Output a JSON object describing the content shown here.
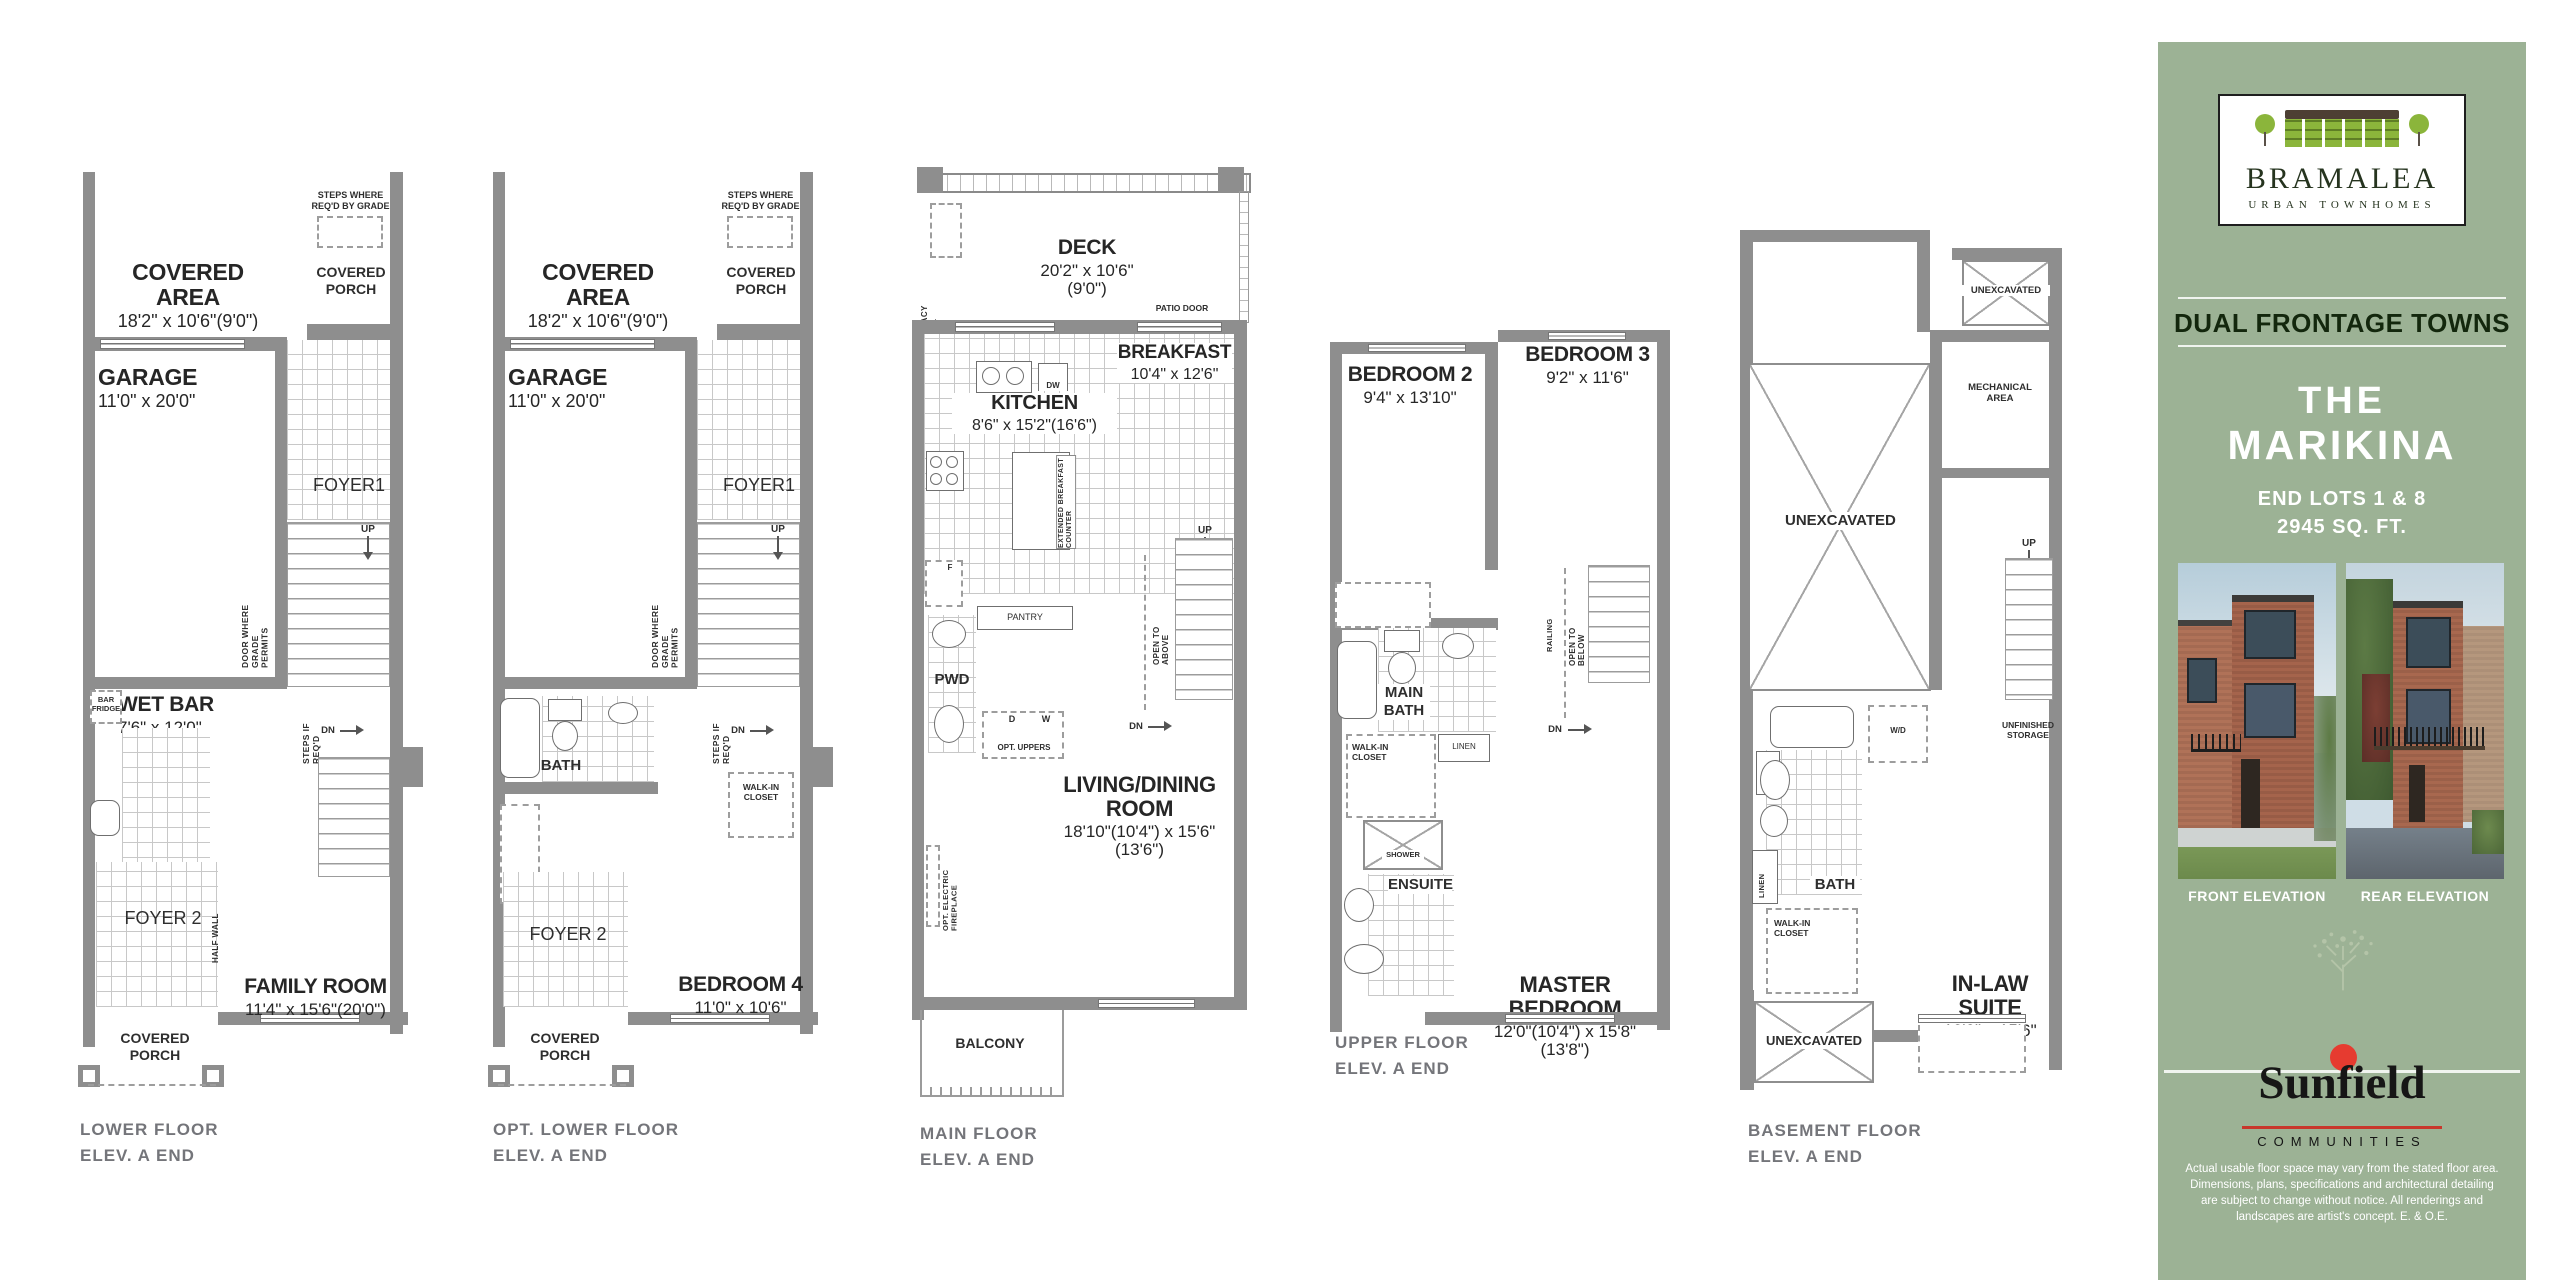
{
  "colors": {
    "panelGreen": "#9cb295",
    "wallGray": "#8e8e8e",
    "logoGreen": "#8bb53b",
    "roofBrown": "#4d3f33",
    "sunRed": "#e63b30"
  },
  "captions": {
    "lower": "LOWER FLOOR\nELEV. A END",
    "optLower": "OPT. LOWER FLOOR\nELEV. A END",
    "main": "MAIN FLOOR\nELEV. A END",
    "upper": "UPPER FLOOR\nELEV. A END",
    "basement": "BASEMENT FLOOR\nELEV. A END"
  },
  "lower": {
    "coveredArea": "COVERED AREA",
    "coveredAreaDims": "18'2\" x 10'6\"(9'0\")",
    "stepsGrade": "STEPS WHERE\nREQ'D BY GRADE",
    "coveredPorch": "COVERED\nPORCH",
    "garage": "GARAGE",
    "garageDims": "11'0\" x 20'0\"",
    "foyer1": "FOYER1",
    "up": "UP",
    "doorGrade": "DOOR WHERE\nGRADE PERMITS",
    "wetBar": "WET BAR",
    "wetBarDims": "7'6\" x 12'0\"",
    "barFridge": "BAR\nFRIDGE",
    "stepsReq": "STEPS IF REQ'D",
    "dn": "DN",
    "foyer2": "FOYER 2",
    "halfWall": "HALF WALL",
    "familyRoom": "FAMILY ROOM",
    "familyRoomDims": "11'4\" x 15'6\"(20'0\")",
    "porchBottom": "COVERED\nPORCH"
  },
  "optLower": {
    "coveredArea": "COVERED AREA",
    "coveredAreaDims": "18'2\" x 10'6\"(9'0\")",
    "stepsGrade": "STEPS WHERE\nREQ'D BY GRADE",
    "coveredPorch": "COVERED\nPORCH",
    "garage": "GARAGE",
    "garageDims": "11'0\" x 20'0\"",
    "foyer1": "FOYER1",
    "up": "UP",
    "doorGrade": "DOOR WHERE\nGRADE PERMITS",
    "bath": "BATH",
    "walkIn": "WALK-IN\nCLOSET",
    "stepsReq": "STEPS IF REQ'D",
    "dn": "DN",
    "foyer2": "FOYER 2",
    "bedroom4": "BEDROOM 4",
    "bedroom4Dims": "11'0\" x 10'6\"",
    "porchBottom": "COVERED\nPORCH"
  },
  "main": {
    "deck": "DECK",
    "deckDims": "20'2\" x 10'6\"(9'0\")",
    "privacyWall": "PRIVACY WALL",
    "patioDoor": "PATIO DOOR",
    "breakfast": "BREAKFAST",
    "breakfastDims": "10'4\" x 12'6\"",
    "kitchen": "KITCHEN",
    "kitchenDims": "8'6\" x 15'2\"(16'6\")",
    "dw": "DW",
    "extCounter": "EXTENDED BREAKFAST COUNTER",
    "fridge": "F",
    "pantry": "PANTRY",
    "pwd": "PWD",
    "d": "D",
    "w": "W",
    "optUppers": "OPT. UPPERS",
    "up": "UP",
    "openAbove": "OPEN TO ABOVE",
    "dn": "DN",
    "living": "LIVING/DINING ROOM",
    "livingDims": "18'10\"(10'4\") x 15'6\"(13'6\")",
    "optFireplace": "OPT. ELECTRIC FIREPLACE",
    "balcony": "BALCONY"
  },
  "upper": {
    "bedroom2": "BEDROOM 2",
    "bedroom2Dims": "9'4\" x 13'10\"",
    "bedroom3": "BEDROOM 3",
    "bedroom3Dims": "9'2\" x 11'6\"",
    "railing": "RAILING",
    "openBelow": "OPEN TO BELOW",
    "dn": "DN",
    "mainBath": "MAIN\nBATH",
    "linen": "LINEN",
    "walkIn": "WALK-IN\nCLOSET",
    "shower": "SHOWER",
    "ensuite": "ENSUITE",
    "master": "MASTER BEDROOM",
    "masterDims": "12'0\"(10'4\") x 15'8\"(13'8\")"
  },
  "basement": {
    "unexcTop": "UNEXCAVATED",
    "mechanical": "MECHANICAL\nAREA",
    "unexcMain": "UNEXCAVATED",
    "up": "UP",
    "unfinished": "UNFINISHED\nSTORAGE",
    "wd": "W/D",
    "bath": "BATH",
    "linen": "LINEN",
    "walkIn": "WALK-IN\nCLOSET",
    "inlaw": "IN-LAW SUITE",
    "inlawDims": "12'0\" x 15'6\"",
    "unexcBottom": "UNEXCAVATED"
  },
  "sidebar": {
    "brandName": "BRAMALEA",
    "brandTag": "URBAN TOWNHOMES",
    "program": "DUAL FRONTAGE TOWNS",
    "modelThe": "THE",
    "modelName": "MARIKINA",
    "lots": "END LOTS 1 & 8",
    "sqft": "2945 SQ. FT.",
    "frontLabel": "FRONT ELEVATION",
    "rearLabel": "REAR ELEVATION",
    "builderName": "Sunfield",
    "builderSub": "COMMUNITIES",
    "disclaimer": "Actual usable floor space may vary from the stated floor area. Dimensions, plans, specifications and architectural detailing are subject to change without notice. All renderings and landscapes are artist's concept. E. & O.E."
  }
}
